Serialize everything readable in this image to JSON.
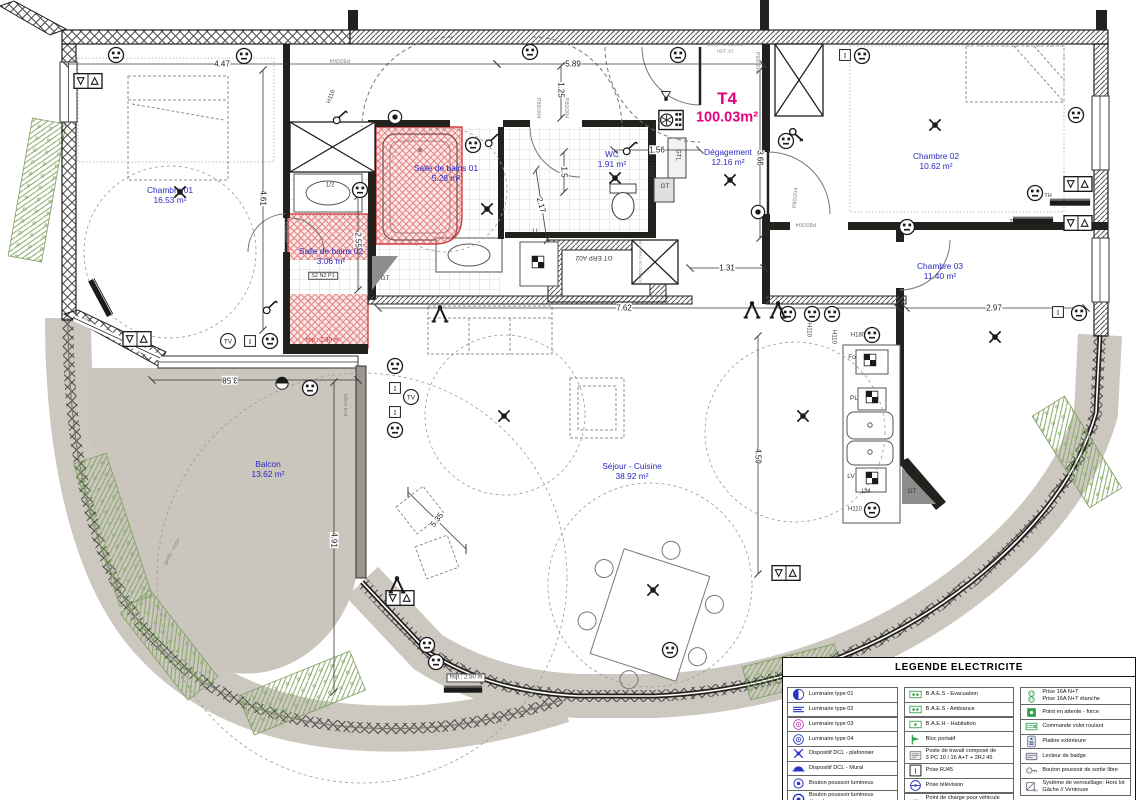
{
  "colors": {
    "room": "#2a2ac0",
    "accent": "#e5007d",
    "red": "#c32222",
    "wall": "#23211e"
  },
  "unit": {
    "label": "T4",
    "area": "100.03m²",
    "x": 727,
    "y": 99
  },
  "rooms": [
    {
      "name": "Chambre 01",
      "area": "16.53 m²",
      "x": 170,
      "y": 196
    },
    {
      "name": "Salle de bains 01",
      "area": "5.28 m²",
      "x": 446,
      "y": 174
    },
    {
      "name": "WC",
      "area": "1.91 m²",
      "x": 612,
      "y": 160
    },
    {
      "name": "Dégagement",
      "area": "12.16 m²",
      "x": 728,
      "y": 158
    },
    {
      "name": "Chambre 02",
      "area": "10.62 m²",
      "x": 936,
      "y": 162
    },
    {
      "name": "Chambre 03",
      "area": "11.40 m²",
      "x": 940,
      "y": 272
    },
    {
      "name": "Séjour - Cuisine",
      "area": "38.92 m²",
      "x": 632,
      "y": 472
    },
    {
      "name": "Balcon",
      "area": "13.62 m²",
      "x": 268,
      "y": 470
    },
    {
      "name": "Salle de bains 02",
      "area": "3.06 m²",
      "x": 331,
      "y": 257
    }
  ],
  "dimensions": [
    {
      "t": "4.47",
      "x": 222,
      "y": 64,
      "l": [
        65,
        64,
        497,
        64
      ]
    },
    {
      "t": "5.89",
      "x": 573,
      "y": 64,
      "l": [
        497,
        64,
        763,
        64
      ]
    },
    {
      "t": "1.25",
      "x": 561,
      "y": 90,
      "r": 90,
      "l": [
        561,
        66,
        561,
        118
      ]
    },
    {
      "t": "3.66",
      "x": 760,
      "y": 158,
      "r": 90,
      "l": [
        760,
        70,
        760,
        238
      ]
    },
    {
      "t": "4.61",
      "x": 263,
      "y": 198,
      "r": 90,
      "l": [
        263,
        70,
        263,
        330
      ]
    },
    {
      "t": "2.55",
      "x": 358,
      "y": 240,
      "r": 90,
      "l": [
        358,
        196,
        358,
        290
      ]
    },
    {
      "t": "2.17",
      "x": 541,
      "y": 205,
      "r": 75,
      "l": [
        536,
        170,
        547,
        240
      ]
    },
    {
      "t": "1.5",
      "x": 564,
      "y": 172,
      "r": 90,
      "l": [
        564,
        152,
        564,
        192
      ]
    },
    {
      "t": "1.56",
      "x": 657,
      "y": 150,
      "l": [
        614,
        150,
        700,
        150
      ]
    },
    {
      "t": "1.31",
      "x": 727,
      "y": 268,
      "l": [
        690,
        268,
        764,
        268
      ]
    },
    {
      "t": "7.62",
      "x": 624,
      "y": 308,
      "l": [
        378,
        308,
        898,
        308
      ]
    },
    {
      "t": "2.97",
      "x": 994,
      "y": 308,
      "l": [
        906,
        308,
        1086,
        308
      ]
    },
    {
      "t": "4.59",
      "x": 758,
      "y": 456,
      "r": 90,
      "l": [
        758,
        336,
        758,
        574
      ]
    },
    {
      "t": "4.91",
      "x": 334,
      "y": 540,
      "r": 90,
      "l": [
        334,
        382,
        334,
        692
      ]
    },
    {
      "t": "3.58",
      "x": 230,
      "y": 380,
      "r": 180,
      "l": [
        152,
        380,
        358,
        380
      ]
    },
    {
      "t": "5.35",
      "x": 437,
      "y": 520,
      "r": -52,
      "l": [
        408,
        492,
        466,
        549
      ]
    }
  ],
  "notes": [
    {
      "t": "P80/204",
      "x": 340,
      "y": 60,
      "r": 180,
      "s": 5.5,
      "c": "gray"
    },
    {
      "t": "H116",
      "x": 332,
      "y": 97,
      "r": -70,
      "s": 6
    },
    {
      "t": "P80/204",
      "x": 538,
      "y": 108,
      "r": 90,
      "s": 5.5,
      "c": "gray"
    },
    {
      "t": "P80/204",
      "x": 566,
      "y": 108,
      "r": 90,
      "s": 5.5,
      "c": "gray"
    },
    {
      "t": "P90/204",
      "x": 757,
      "y": 62,
      "r": 90,
      "s": 5.5,
      "c": "gray"
    },
    {
      "t": "PORTE PALIERE",
      "x": 725,
      "y": 44,
      "r": 180,
      "s": 4.5,
      "c": "gray"
    },
    {
      "t": "CF 1/2H",
      "x": 725,
      "y": 51,
      "r": 180,
      "s": 4.5,
      "c": "gray"
    },
    {
      "t": "P80/204",
      "x": 796,
      "y": 198,
      "r": -85,
      "s": 5.5,
      "c": "gray"
    },
    {
      "t": "P80/204",
      "x": 806,
      "y": 224,
      "r": 180,
      "s": 5.5,
      "c": "gray"
    },
    {
      "t": "P80/204",
      "x": 286,
      "y": 232,
      "r": 90,
      "s": 5.5,
      "c": "gray"
    },
    {
      "t": "H110",
      "x": 650,
      "y": 170,
      "r": 90,
      "s": 6
    },
    {
      "t": "H110",
      "x": 808,
      "y": 330,
      "r": 90,
      "s": 6
    },
    {
      "t": "H110",
      "x": 833,
      "y": 337,
      "r": 90,
      "s": 6
    },
    {
      "t": "H180",
      "x": 858,
      "y": 336,
      "s": 6
    },
    {
      "t": "H110",
      "x": 855,
      "y": 510,
      "s": 6
    },
    {
      "t": "TH",
      "x": 1048,
      "y": 196,
      "s": 5.5
    },
    {
      "t": "TH",
      "x": 1013,
      "y": 222,
      "s": 5.5
    },
    {
      "t": "GT",
      "x": 385,
      "y": 279,
      "s": 6.5
    },
    {
      "t": "GT",
      "x": 665,
      "y": 187,
      "s": 6.5
    },
    {
      "t": "GTL",
      "x": 677,
      "y": 155,
      "r": 90,
      "s": 6
    },
    {
      "t": "GT",
      "x": 912,
      "y": 492,
      "s": 6.5
    },
    {
      "t": "GT ERP A02",
      "x": 594,
      "y": 257,
      "r": 180,
      "s": 6.5
    },
    {
      "t": "LL",
      "x": 536,
      "y": 232,
      "s": 6.5
    },
    {
      "t": "LV",
      "x": 851,
      "y": 477,
      "s": 6.5
    },
    {
      "t": "LM",
      "x": 866,
      "y": 492,
      "s": 6.5
    },
    {
      "t": "Fo",
      "x": 852,
      "y": 358,
      "s": 6.5
    },
    {
      "t": "PL",
      "x": 854,
      "y": 399,
      "s": 6.5
    },
    {
      "t": "béton brut",
      "x": 344,
      "y": 405,
      "r": 90,
      "s": 5,
      "c": "gray"
    },
    {
      "t": "garde - corps",
      "x": 173,
      "y": 552,
      "r": -62,
      "s": 5,
      "c": "gray"
    },
    {
      "t": "SOURCE DE CHALEUR",
      "x": 641,
      "y": 262,
      "r": -90,
      "s": 4,
      "c": "gray"
    },
    {
      "t": "1/2",
      "x": 330,
      "y": 186,
      "s": 6
    },
    {
      "t": "S2 N2 P1",
      "x": 323,
      "y": 276,
      "s": 5.5,
      "box": true
    },
    {
      "t": "hsp : 2.30 m",
      "x": 322,
      "y": 341,
      "s": 6,
      "c": "red"
    },
    {
      "t": "hsp : 2.50 m",
      "x": 466,
      "y": 678,
      "s": 6,
      "box": true
    }
  ],
  "symbols": [
    {
      "t": "pr",
      "x": 116,
      "y": 55
    },
    {
      "t": "pr",
      "x": 244,
      "y": 56
    },
    {
      "t": "pr",
      "x": 530,
      "y": 52
    },
    {
      "t": "pr",
      "x": 678,
      "y": 55
    },
    {
      "t": "pr",
      "x": 862,
      "y": 56
    },
    {
      "t": "pr",
      "x": 1076,
      "y": 115
    },
    {
      "t": "pr",
      "x": 1035,
      "y": 193
    },
    {
      "t": "pr",
      "x": 907,
      "y": 227
    },
    {
      "t": "pr",
      "x": 1079,
      "y": 313
    },
    {
      "t": "pr",
      "x": 872,
      "y": 335
    },
    {
      "t": "pr",
      "x": 788,
      "y": 314
    },
    {
      "t": "pr",
      "x": 812,
      "y": 314
    },
    {
      "t": "pr",
      "x": 832,
      "y": 314
    },
    {
      "t": "pr",
      "x": 473,
      "y": 145
    },
    {
      "t": "pr",
      "x": 360,
      "y": 190
    },
    {
      "t": "pr",
      "x": 786,
      "y": 141
    },
    {
      "t": "pr",
      "x": 270,
      "y": 341
    },
    {
      "t": "pr",
      "x": 395,
      "y": 366
    },
    {
      "t": "pr",
      "x": 395,
      "y": 430
    },
    {
      "t": "pr",
      "x": 310,
      "y": 388
    },
    {
      "t": "pr",
      "x": 427,
      "y": 645
    },
    {
      "t": "pr",
      "x": 436,
      "y": 662
    },
    {
      "t": "pr",
      "x": 670,
      "y": 650
    },
    {
      "t": "pr",
      "x": 872,
      "y": 510
    },
    {
      "t": "vol",
      "x": 88,
      "y": 81
    },
    {
      "t": "vol",
      "x": 137,
      "y": 339
    },
    {
      "t": "vol",
      "x": 1078,
      "y": 184
    },
    {
      "t": "vol",
      "x": 1078,
      "y": 223
    },
    {
      "t": "vol",
      "x": 400,
      "y": 598
    },
    {
      "t": "vol",
      "x": 786,
      "y": 573
    },
    {
      "t": "tv",
      "x": 228,
      "y": 341,
      "txt": "TV"
    },
    {
      "t": "tv",
      "x": 411,
      "y": 397,
      "txt": "TV"
    },
    {
      "t": "rj",
      "x": 250,
      "y": 341,
      "txt": "I"
    },
    {
      "t": "rj",
      "x": 395,
      "y": 388,
      "txt": "I"
    },
    {
      "t": "rj",
      "x": 395,
      "y": 412,
      "txt": "I"
    },
    {
      "t": "rj",
      "x": 845,
      "y": 55,
      "txt": "I"
    },
    {
      "t": "rj",
      "x": 1058,
      "y": 312,
      "txt": "I"
    },
    {
      "t": "lum04",
      "x": 395,
      "y": 117
    },
    {
      "t": "lum04",
      "x": 758,
      "y": 212
    },
    {
      "t": "app",
      "x": 282,
      "y": 383
    },
    {
      "t": "dcl",
      "x": 180,
      "y": 192
    },
    {
      "t": "dcl",
      "x": 487,
      "y": 209
    },
    {
      "t": "dcl",
      "x": 615,
      "y": 178
    },
    {
      "t": "dcl",
      "x": 730,
      "y": 180
    },
    {
      "t": "dcl",
      "x": 935,
      "y": 125
    },
    {
      "t": "dcl",
      "x": 995,
      "y": 337
    },
    {
      "t": "dcl",
      "x": 504,
      "y": 416
    },
    {
      "t": "dcl",
      "x": 653,
      "y": 590
    },
    {
      "t": "dcl",
      "x": 803,
      "y": 416
    },
    {
      "t": "x",
      "x": 440,
      "y": 314
    },
    {
      "t": "x",
      "x": 752,
      "y": 310
    },
    {
      "t": "x",
      "x": 778,
      "y": 310
    },
    {
      "t": "x",
      "x": 397,
      "y": 585
    },
    {
      "t": "sw",
      "x": 340,
      "y": 117
    },
    {
      "t": "sw",
      "x": 492,
      "y": 140
    },
    {
      "t": "sw",
      "x": 630,
      "y": 148
    },
    {
      "t": "sw",
      "x": 270,
      "y": 307
    },
    {
      "t": "key",
      "x": 797,
      "y": 136
    },
    {
      "t": "rad",
      "x": 1070,
      "y": 203,
      "w": 42
    },
    {
      "t": "rad",
      "x": 1033,
      "y": 221,
      "w": 42
    },
    {
      "t": "rad",
      "x": 100,
      "y": 298,
      "w": 42,
      "r": 62
    },
    {
      "t": "rad",
      "x": 463,
      "y": 690,
      "w": 40
    },
    {
      "t": "vmc",
      "x": 671,
      "y": 120
    },
    {
      "t": "fan",
      "x": 666,
      "y": 97
    },
    {
      "t": "chk",
      "x": 870,
      "y": 360
    },
    {
      "t": "chk",
      "x": 872,
      "y": 397
    },
    {
      "t": "chk",
      "x": 872,
      "y": 478
    },
    {
      "t": "chk",
      "x": 538,
      "y": 262
    }
  ],
  "legend": {
    "title": "LEGENDE ELECTRICITE",
    "columns": [
      {
        "rows": [
          {
            "icon": "lum01",
            "label": "Luminaire type 01"
          },
          {
            "icon": "lum02",
            "label": "Luminaire type 02"
          },
          {
            "icon": "lum03",
            "label": "Luminaire type 03"
          },
          {
            "icon": "lum04l",
            "label": "Luminaire type 04"
          },
          {
            "icon": "dcll",
            "label": "Dispositif DCL - plafonnier"
          },
          {
            "icon": "dclm",
            "label": "Dispositif DCL - Mural"
          },
          {
            "icon": "bp",
            "label": "Bouton poussoir lumineux"
          },
          {
            "icon": "bpe",
            "label": "Bouton poussoir lumineux étanche"
          },
          {
            "icon": "int",
            "label": "Interrupteur simple allumage"
          }
        ]
      },
      {
        "rows": [
          {
            "icon": "baes",
            "label": "B.A.E.S - Evacuation"
          },
          {
            "icon": "baes",
            "label": "B.A.E.S - Ambiance"
          },
          {
            "icon": "baeh",
            "label": "B.A.E.H - Habitation"
          },
          {
            "icon": "bloc",
            "label": "Bloc portatif"
          },
          {
            "icon": "poste",
            "label": "Poste de travail composé de\n3 PC 10 / 16 A+T + 2RJ 45"
          },
          {
            "icon": "rj",
            "icon_txt": "I",
            "label": "Prise RJ45"
          },
          {
            "icon": "tvp",
            "label": "Prise télévision"
          },
          {
            "icon": "charge",
            "label": "Point de charge pour véhicule\nélectrique:\nType de pose:"
          }
        ]
      },
      {
        "rows": [
          {
            "icon": "p16",
            "label": "Prise 16A N+T\nPrise 16A N+T étanche"
          },
          {
            "icon": "force",
            "label": "Point en attente - force"
          },
          {
            "icon": "cvr",
            "label": "Commande volet roulant"
          },
          {
            "icon": "plat",
            "label": "Platine extérieure"
          },
          {
            "icon": "badge",
            "label": "Lecteur de badge"
          },
          {
            "icon": "sortie",
            "label": "Bouton poussoir de sortie libre"
          },
          {
            "icon": "verrou",
            "icon_txt": "Ven",
            "label": "Système de verrouillage: Hors lot\nGâche // Ventouse"
          }
        ]
      }
    ]
  }
}
